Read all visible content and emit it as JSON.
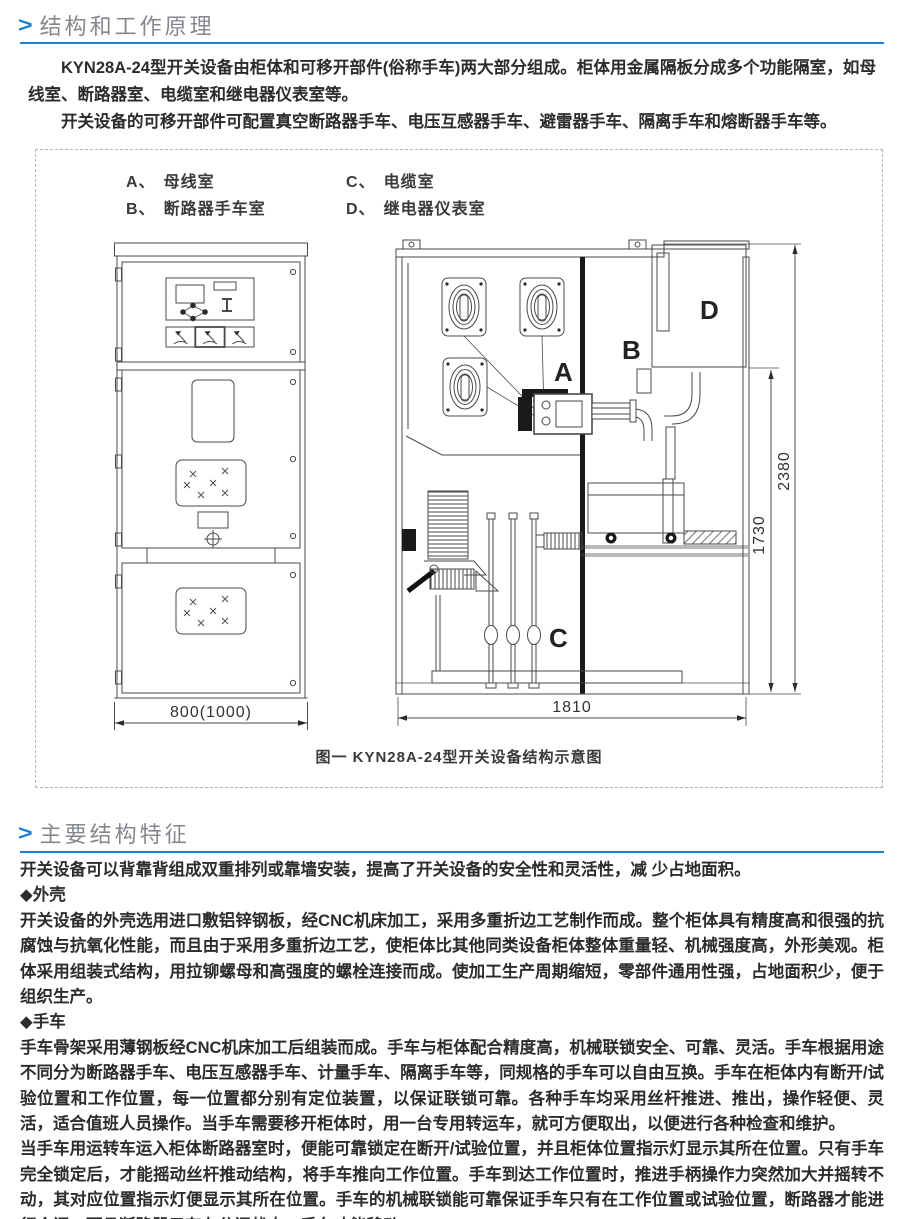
{
  "document": {
    "section1": {
      "marker": ">",
      "title": "结构和工作原理",
      "paragraph1": "KYN28A-24型开关设备由柜体和可移开部件(俗称手车)两大部分组成。柜体用金属隔板分成多个功能隔室，如母线室、断路器室、电缆室和继电器仪表室等。",
      "paragraph2": "开关设备的可移开部件可配置真空断路器手车、电压互感器手车、避雷器手车、隔离手车和熔断器手车等。"
    },
    "figure": {
      "legend": [
        {
          "key": "A、",
          "label": "母线室"
        },
        {
          "key": "B、",
          "label": "断路器手车室"
        },
        {
          "key": "C、",
          "label": "电缆室"
        },
        {
          "key": "D、",
          "label": "继电器仪表室"
        }
      ],
      "front_view": {
        "width_dim": "800(1000)"
      },
      "side_view": {
        "label_a": "A",
        "label_b": "B",
        "label_c": "C",
        "label_d": "D",
        "overall_height_dim": "2380",
        "lower_section_dim": "1730",
        "depth_dim": "1810"
      },
      "caption": "图一  KYN28A-24型开关设备结构示意图"
    },
    "section2": {
      "marker": ">",
      "title": "主要结构特征",
      "intro": "开关设备可以背靠背组成双重排列或靠墙安装，提高了开关设备的安全性和灵活性，减 少占地面积。",
      "feature1_heading": "◆外壳",
      "feature1_body": "开关设备的外壳选用进口敷铝锌钢板，经CNC机床加工，采用多重折边工艺制作而成。整个柜体具有精度高和很强的抗腐蚀与抗氧化性能，而且由于采用多重折边工艺，使柜体比其他同类设备柜体整体重量轻、机械强度高，外形美观。柜体采用组装式结构，用拉铆螺母和高强度的螺栓连接而成。使加工生产周期缩短，零部件通用性强，占地面积少，便于组织生产。",
      "feature2_heading": "◆手车",
      "feature2_body": "手车骨架采用薄钢板经CNC机床加工后组装而成。手车与柜体配合精度高，机械联锁安全、可靠、灵活。手车根据用途不同分为断路器手车、电压互感器手车、计量手车、隔离手车等，同规格的手车可以自由互换。手车在柜体内有断开/试验位置和工作位置，每一位置都分别有定位装置，以保证联锁可靠。各种手车均采用丝杆推进、推出，操作轻便、灵活，适合值班人员操作。当手车需要移开柜体时，用一台专用转运车，就可方便取出，以便进行各种检查和维护。",
      "closing": "当手车用运转车运入柜体断路器室时，便能可靠锁定在断开/试验位置，并且柜体位置指示灯显示其所在位置。只有手车完全锁定后，才能摇动丝杆推动结构，将手车推向工作位置。手车到达工作位置时，推进手柄操作力突然加大并摇转不动，其对应位置指示灯便显示其所在位置。手车的机械联锁能可靠保证手车只有在工作位置或试验位置，断路器才能进行合闸；而且断路器只有在分闸状态，手车才能移动。"
    },
    "colors": {
      "accent_blue": "#1b7fd4",
      "title_gray": "#84888d"
    }
  }
}
